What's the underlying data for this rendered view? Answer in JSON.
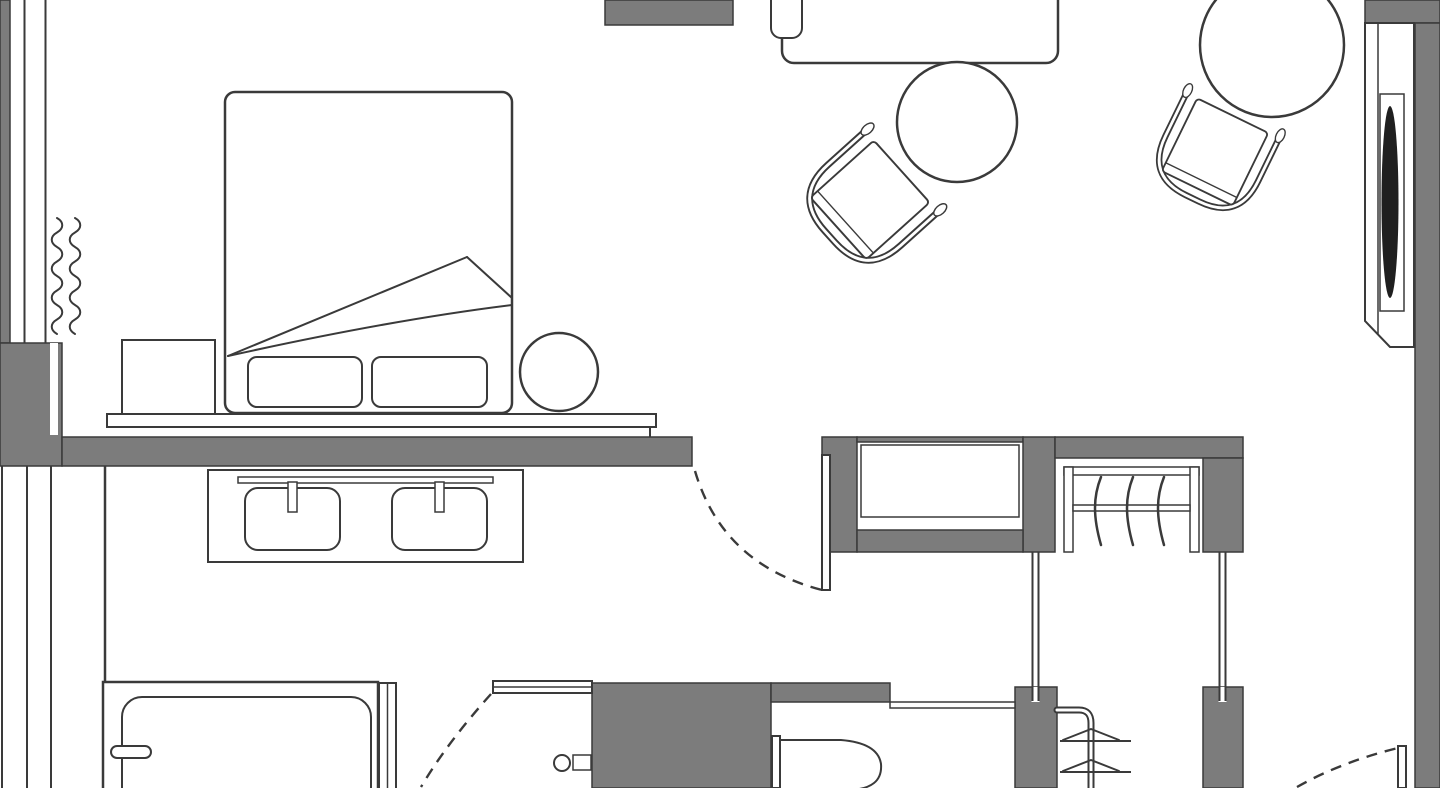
{
  "title": "Hotel room floor plan",
  "canvas": {
    "width": 1440,
    "height": 788
  },
  "colors": {
    "background": "#ffffff",
    "wall": "#7c7c7c",
    "line": "#3a3a3a",
    "dark_fixture": "#1f1f1f"
  },
  "rooms": [
    {
      "id": "bedroom",
      "label": "Bedroom"
    },
    {
      "id": "sitting-area",
      "label": "Sitting area"
    },
    {
      "id": "hallway",
      "label": "Hallway"
    },
    {
      "id": "walk-in-closet",
      "label": "Walk-in closet"
    },
    {
      "id": "bathroom",
      "label": "Bathroom"
    },
    {
      "id": "wc",
      "label": "WC"
    }
  ],
  "elements": {
    "bedroom": [
      "window-wall",
      "radiator",
      "double-bed",
      "duvet-fold",
      "pillow-left",
      "pillow-right",
      "nightstand",
      "side-stool",
      "headboard-ledge",
      "vanity-counter",
      "sink-left",
      "sink-right",
      "faucet-left",
      "faucet-right"
    ],
    "sitting_area": [
      "desk",
      "desk-chair",
      "round-table-small",
      "round-table-large",
      "armchair-near-desk",
      "armchair-near-window",
      "tv-niche-panel"
    ],
    "doors": [
      "bedroom-door",
      "bathroom-door",
      "entry-door"
    ],
    "closet": [
      "cabinet-niche",
      "wardrobe-top-rail",
      "wardrobe-rod",
      "hanger-1",
      "hanger-2",
      "hanger-3",
      "corridor-partition-left",
      "corridor-partition-right"
    ],
    "bathroom": [
      "bathtub",
      "tub-faucet",
      "shower-glass-panel",
      "shower-valve",
      "toilet",
      "toilet-cistern",
      "towel-rail",
      "partition-wall"
    ]
  },
  "counts": {
    "hangers": 3,
    "sinks": 2,
    "door_swings": 3,
    "round_tables": 2,
    "armchairs": 2
  }
}
